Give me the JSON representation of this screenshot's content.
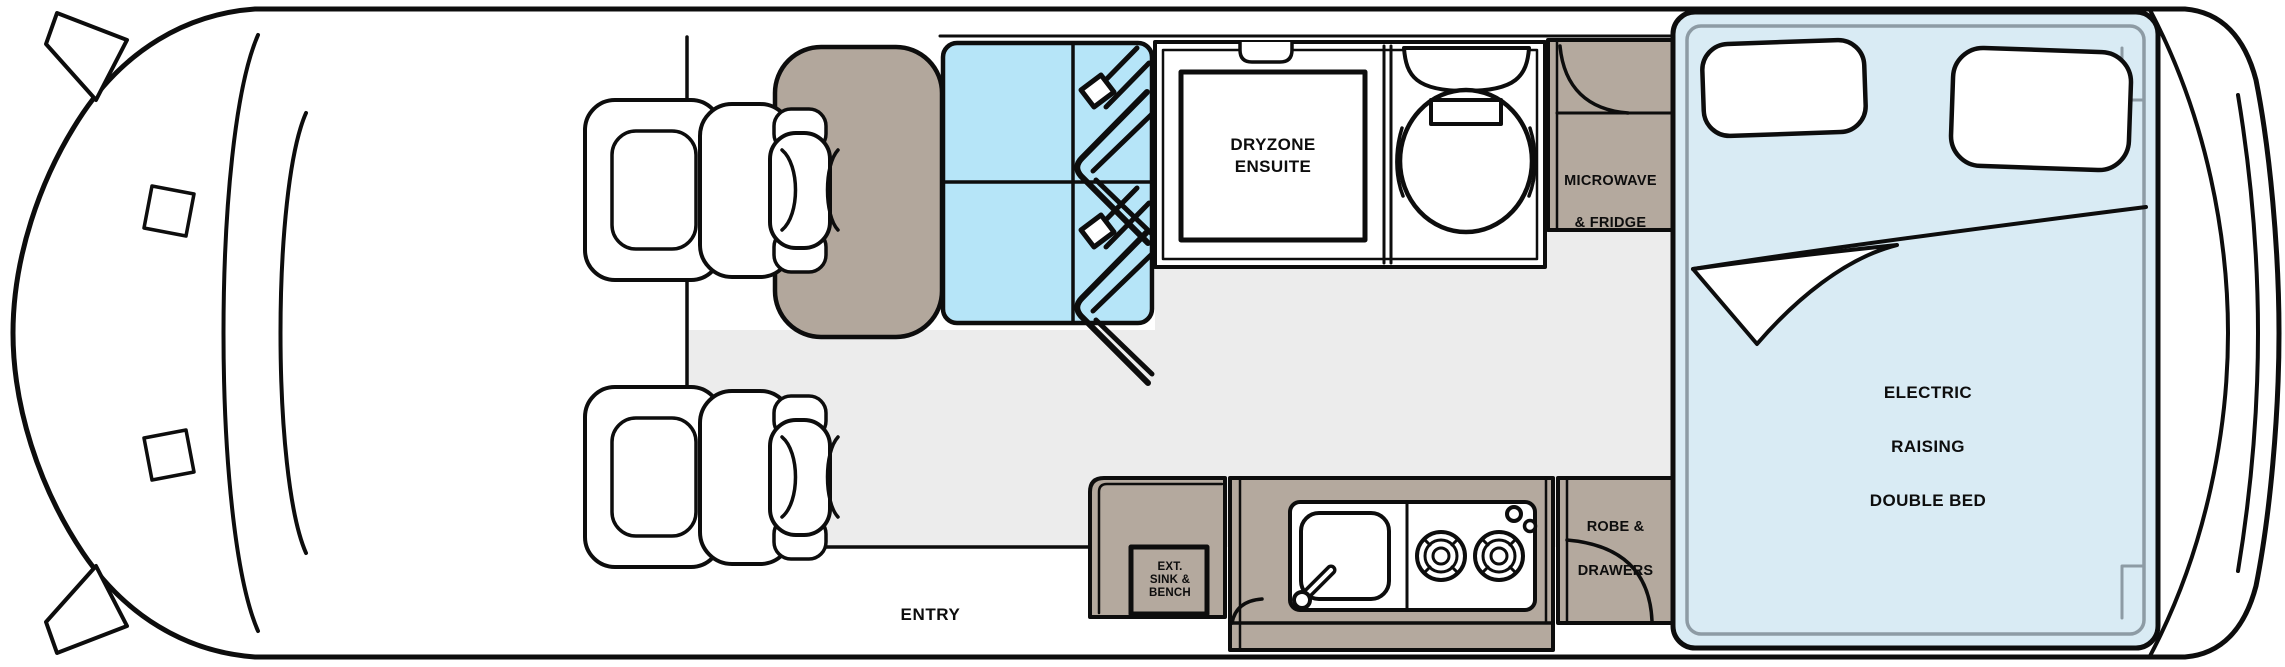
{
  "floorplan": {
    "type": "motorhome-floorplan",
    "labels": {
      "ensuite_line1": "DRYZONE",
      "ensuite_line2": "ENSUITE",
      "microwave_line1": "MICROWAVE",
      "microwave_line2": "& FRIDGE",
      "ext_sink_line1": "EXT.",
      "ext_sink_line2": "SINK &",
      "ext_sink_line3": "BENCH",
      "robe_line1": "ROBE &",
      "robe_line2": "DRAWERS",
      "entry": "ENTRY",
      "bed_line1": "ELECTRIC",
      "bed_line2": "RAISING",
      "bed_line3": "DOUBLE BED"
    },
    "colors": {
      "cabinet_brown": "#b4a99e",
      "seat_brown": "#b2a79c",
      "travel_seat_blue": "#b6e5f8",
      "bed_blue": "#d9ebf4",
      "floor_gray": "#ececec",
      "bed_frame_gray": "#8d9ba4",
      "line_black": "#0d0d0d",
      "background": "#ffffff"
    },
    "areas": {
      "ensuite": "DRYZONE ENSUITE",
      "microwave_fridge": "MICROWAVE & FRIDGE",
      "ext_sink_bench": "EXT. SINK & BENCH",
      "robe_drawers": "ROBE & DRAWERS",
      "entry": "ENTRY",
      "bed": "ELECTRIC RAISING DOUBLE BED"
    }
  }
}
